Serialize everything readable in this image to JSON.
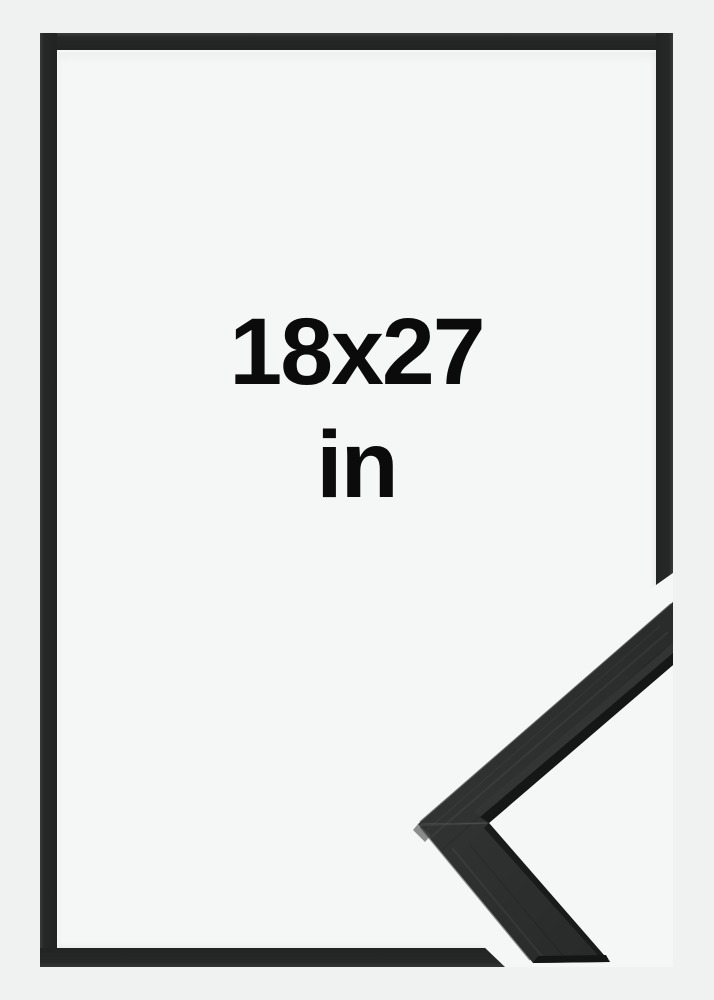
{
  "size_label": {
    "dimensions": "18x27",
    "unit": "in"
  },
  "frame_preview": {
    "style_color": "black",
    "corner_detail": "black-wood-molding-corner-closeup"
  },
  "colors": {
    "page_background": "#f0f1f1",
    "frame_interior": "#f5f6f6",
    "frame_bar": "#242525",
    "molding_face": "#2d2f2f",
    "molding_edge_dark": "#161717",
    "molding_highlight": "#4d4f4f",
    "label_text": "#0b0b0c"
  }
}
